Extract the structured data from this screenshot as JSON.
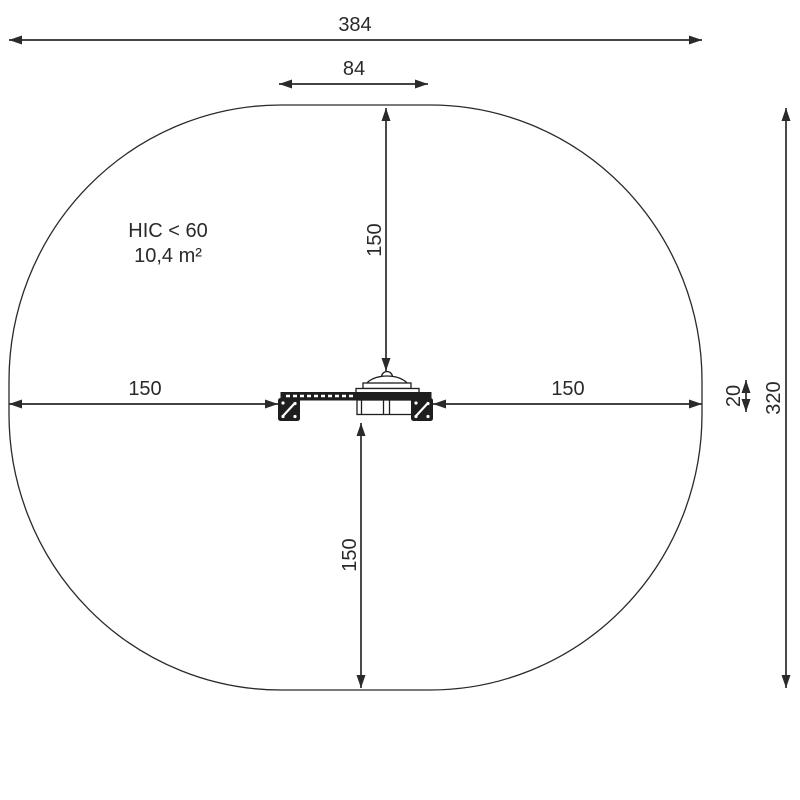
{
  "drawing": {
    "hic_label": "HIC < 60",
    "area_label": "10,4 m²"
  },
  "dimensions": {
    "total_width": "384",
    "item_width": "84",
    "top_clearance": "150",
    "left_clearance": "150",
    "right_clearance": "150",
    "bottom_clearance": "150",
    "item_depth": "20",
    "total_depth": "320"
  },
  "colors": {
    "ink": "#2a2a2a",
    "background": "#ffffff"
  }
}
